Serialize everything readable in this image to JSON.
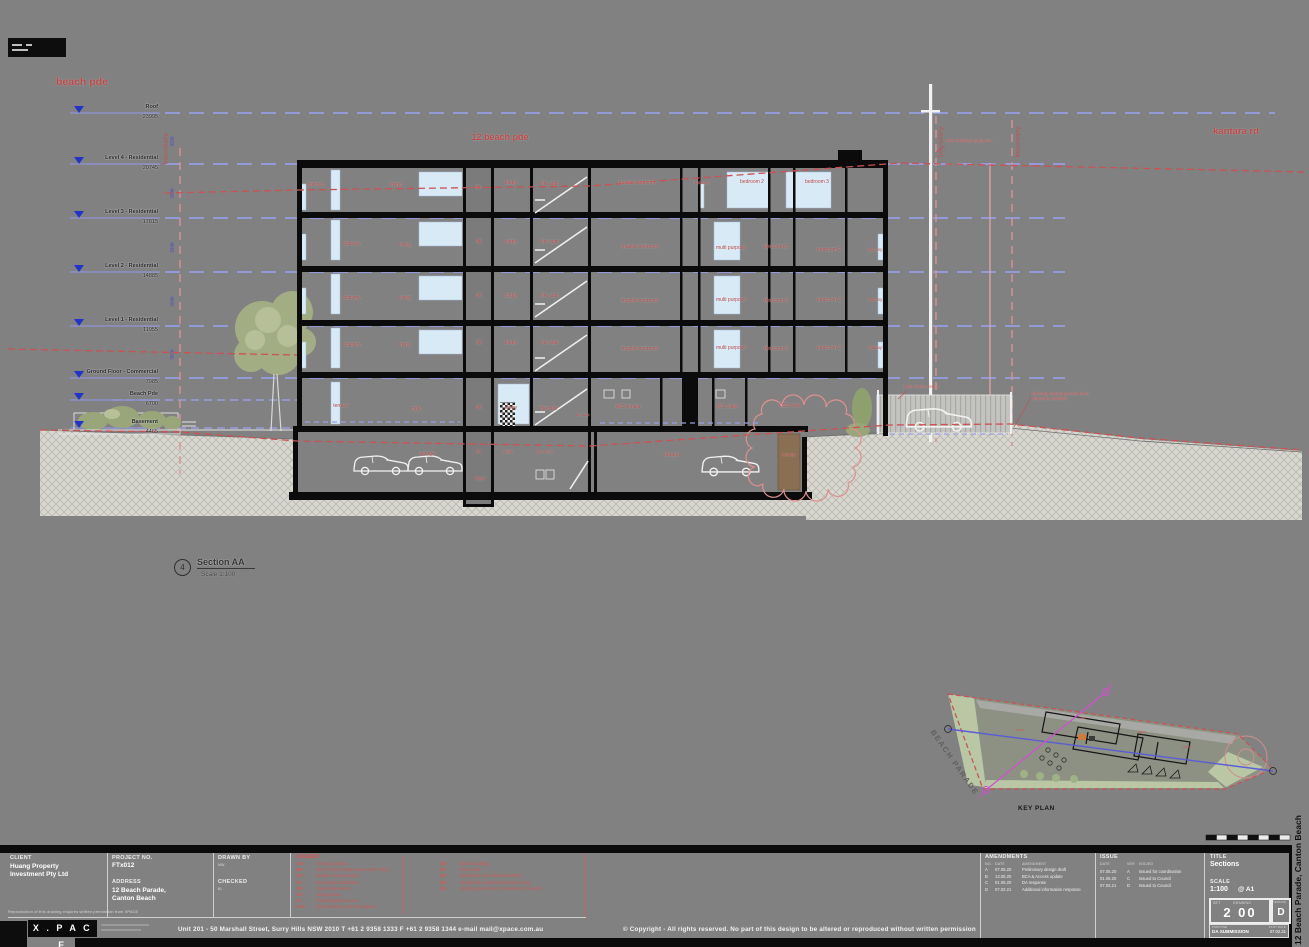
{
  "streets": {
    "beach_pde": "beach pde",
    "site": "12 beach pde",
    "kantara_rd": "kantara rd"
  },
  "drawing": {
    "boundary_label": "boundary",
    "boundary_positions": [
      {
        "x": 166,
        "y": 145
      },
      {
        "x": 941,
        "y": 138
      },
      {
        "x": 1018,
        "y": 138
      }
    ],
    "level_markers": [
      {
        "name": "Roof",
        "rl": "23995",
        "y": 113
      },
      {
        "name": "Level 4 - Residential",
        "rl": "20745",
        "y": 164
      },
      {
        "name": "Level 3 - Residential",
        "rl": "17815",
        "y": 218
      },
      {
        "name": "Level 2 - Residential",
        "rl": "14885",
        "y": 272
      },
      {
        "name": "Level 1 - Residential",
        "rl": "11955",
        "y": 326
      },
      {
        "name": "Ground Floor - Commercial",
        "rl": "7985",
        "y": 378
      },
      {
        "name": "Beach Pde",
        "rl": "6700",
        "y": 400
      },
      {
        "name": "Basement",
        "rl": "4465",
        "y": 428
      }
    ],
    "dims": [
      {
        "v": "3250",
        "y": 139
      },
      {
        "v": "2930",
        "y": 191
      },
      {
        "v": "2930",
        "y": 245
      },
      {
        "v": "2930",
        "y": 299
      },
      {
        "v": "3970",
        "y": 352
      }
    ],
    "room_labels": [
      {
        "t": "balcony",
        "x": 316,
        "y": 183,
        "w": 30
      },
      {
        "t": "living",
        "x": 396,
        "y": 183,
        "w": 30
      },
      {
        "t": "lift",
        "x": 478,
        "y": 186,
        "w": 20
      },
      {
        "t": "lobby",
        "x": 511,
        "y": 181,
        "w": 24
      },
      {
        "t": "fire stair",
        "x": 550,
        "y": 182,
        "w": 40
      },
      {
        "t": "master bedroom",
        "x": 637,
        "y": 181,
        "w": 40
      },
      {
        "t": "balcony",
        "x": 702,
        "y": 181,
        "w": 26,
        "s": 4.2
      },
      {
        "t": "bedroom 2",
        "x": 752,
        "y": 180,
        "w": 50
      },
      {
        "t": "bedroom 3",
        "x": 817,
        "y": 180,
        "w": 50
      },
      {
        "t": "balcony",
        "x": 352,
        "y": 242,
        "w": 30
      },
      {
        "t": "living",
        "x": 405,
        "y": 243,
        "w": 30
      },
      {
        "t": "lift",
        "x": 479,
        "y": 240,
        "w": 20
      },
      {
        "t": "lobby",
        "x": 511,
        "y": 240,
        "w": 24
      },
      {
        "t": "fire stair",
        "x": 550,
        "y": 240,
        "w": 40
      },
      {
        "t": "master bedroom",
        "x": 640,
        "y": 245,
        "w": 40
      },
      {
        "t": "multi purpose",
        "x": 731,
        "y": 246,
        "w": 60
      },
      {
        "t": "bedroom 3",
        "x": 776,
        "y": 245,
        "w": 26
      },
      {
        "t": "bedroom 2",
        "x": 829,
        "y": 248,
        "w": 42
      },
      {
        "t": "balcony",
        "x": 875,
        "y": 248,
        "w": 28,
        "s": 4.2
      },
      {
        "t": "balcony",
        "x": 352,
        "y": 296,
        "w": 30
      },
      {
        "t": "living",
        "x": 405,
        "y": 296,
        "w": 30
      },
      {
        "t": "lift",
        "x": 479,
        "y": 294,
        "w": 20
      },
      {
        "t": "lobby",
        "x": 511,
        "y": 294,
        "w": 24
      },
      {
        "t": "fire stair",
        "x": 550,
        "y": 294,
        "w": 40
      },
      {
        "t": "master bedroom",
        "x": 640,
        "y": 299,
        "w": 40
      },
      {
        "t": "multi purpose",
        "x": 731,
        "y": 298,
        "w": 60
      },
      {
        "t": "bedroom 3",
        "x": 776,
        "y": 299,
        "w": 26
      },
      {
        "t": "bedroom 2",
        "x": 829,
        "y": 298,
        "w": 42
      },
      {
        "t": "balcony",
        "x": 875,
        "y": 298,
        "w": 28,
        "s": 4.2
      },
      {
        "t": "balcony",
        "x": 352,
        "y": 343,
        "w": 30
      },
      {
        "t": "living",
        "x": 405,
        "y": 343,
        "w": 30
      },
      {
        "t": "lift",
        "x": 479,
        "y": 341,
        "w": 20
      },
      {
        "t": "lobby",
        "x": 511,
        "y": 341,
        "w": 24
      },
      {
        "t": "fire stair",
        "x": 550,
        "y": 341,
        "w": 40
      },
      {
        "t": "master bedroom",
        "x": 640,
        "y": 347,
        "w": 40
      },
      {
        "t": "multi purpose",
        "x": 731,
        "y": 346,
        "w": 60
      },
      {
        "t": "bedroom 3",
        "x": 776,
        "y": 347,
        "w": 26
      },
      {
        "t": "bedroom 2",
        "x": 829,
        "y": 346,
        "w": 42
      },
      {
        "t": "hallway",
        "x": 875,
        "y": 346,
        "w": 32,
        "s": 4.2
      },
      {
        "t": "terrace",
        "x": 341,
        "y": 404,
        "w": 32
      },
      {
        "t": "cafe",
        "x": 416,
        "y": 407,
        "w": 26
      },
      {
        "t": "lift",
        "x": 479,
        "y": 406,
        "w": 20
      },
      {
        "t": "lobby",
        "x": 511,
        "y": 406,
        "w": 24
      },
      {
        "t": "fire stair",
        "x": 549,
        "y": 407,
        "w": 40
      },
      {
        "t": "fire stair",
        "x": 583,
        "y": 413,
        "w": 20,
        "s": 3.8
      },
      {
        "t": "WC female",
        "x": 628,
        "y": 405,
        "w": 26
      },
      {
        "t": "WC male",
        "x": 727,
        "y": 405,
        "w": 24
      },
      {
        "t": "OSD tank",
        "x": 790,
        "y": 404,
        "w": 36
      },
      {
        "t": "garage",
        "x": 427,
        "y": 452,
        "w": 30
      },
      {
        "t": "lift",
        "x": 479,
        "y": 450,
        "w": 18,
        "s": 4.2
      },
      {
        "t": "lift pit",
        "x": 480,
        "y": 477,
        "w": 26,
        "s": 4.2
      },
      {
        "t": "lobby",
        "x": 508,
        "y": 450,
        "w": 24,
        "s": 4.2
      },
      {
        "t": "bin room",
        "x": 545,
        "y": 450,
        "w": 22,
        "s": 4.2
      },
      {
        "t": "garage",
        "x": 672,
        "y": 453,
        "w": 30
      },
      {
        "t": "storage",
        "x": 789,
        "y": 453,
        "w": 34,
        "s": 4.2
      }
    ],
    "annotations": {
      "height_line": "13m building height line",
      "timber_fence": "1.8m timber fence",
      "ground_note_1": "Existing natural ground level",
      "ground_note_2": "shown as dashed"
    },
    "section_callout": {
      "bubble": "4",
      "name": "Section AA",
      "scale": "Scale  1:100"
    },
    "key_plan": {
      "caption": "KEY PLAN",
      "street": "BEACH PARADE"
    }
  },
  "titleblock": {
    "client_label": "CLIENT",
    "client_1": "Huang Property",
    "client_2": "Investment Pty Ltd",
    "project_no_label": "PROJECT NO.",
    "project_no": "FTx012",
    "address_label": "ADDRESS",
    "address_1": "12 Beach Parade,",
    "address_2": "Canton Beach",
    "drawn_label": "DRAWN BY",
    "drawn": "MW",
    "checked_label": "CHECKED",
    "checked": "BL",
    "legend_label": "LEGEND",
    "legend_col1": [
      {
        "code": "AW",
        "desc": "Awning window"
      },
      {
        "code": "BB",
        "desc": "Breeze block (style and colour TBC)"
      },
      {
        "code": "DH",
        "desc": "Double hung window"
      },
      {
        "code": "FG",
        "desc": "Fixed glass windows"
      },
      {
        "code": "GB",
        "desc": "Glass balustrade"
      },
      {
        "code": "HD",
        "desc": "Hinged door"
      },
      {
        "code": "LV",
        "desc": "Fixed blades louvres"
      },
      {
        "code": "LVG",
        "desc": "Fixed blades over fixed glass"
      }
    ],
    "legend_col2": [
      {
        "code": "MC",
        "desc": "Metal cladding"
      },
      {
        "code": "PD",
        "desc": "Pivot door"
      },
      {
        "code": "RE",
        "desc": "Rendered and Painted (White)"
      },
      {
        "code": "RD",
        "desc": "Rendered and Painted (Dark Grey)"
      },
      {
        "code": "SD",
        "desc": "Sliding glass doors (Aluminium Framed)"
      }
    ],
    "amendments_label": "AMENDMENTS",
    "amendments_cols": [
      "NO.",
      "DATE",
      "AMENDMENT"
    ],
    "amendments": [
      {
        "no": "A",
        "date": "07.05.20",
        "desc": "Preliminary design draft"
      },
      {
        "no": "B",
        "date": "13.05.20",
        "desc": "BCA & Access update"
      },
      {
        "no": "C",
        "date": "01.06.20",
        "desc": "DA response"
      },
      {
        "no": "D",
        "date": "07.02.21",
        "desc": "Additional information response"
      }
    ],
    "issue_label": "ISSUE",
    "issue_cols": [
      "DATE",
      "VER",
      "ISSUED"
    ],
    "issues": [
      {
        "date": "07.05.20",
        "ver": "A",
        "desc": "Issued for coordination"
      },
      {
        "date": "01.06.20",
        "ver": "C",
        "desc": "Issued to Council"
      },
      {
        "date": "07.02.21",
        "ver": "D",
        "desc": "Issued to Council"
      }
    ],
    "title_label": "TITLE",
    "title": "Sections",
    "scale_label": "SCALE",
    "scale": "1:100",
    "scale_paper": "@ A1",
    "no_label_left": "SET",
    "no_label_right": "DRAWING",
    "drawing_no": "2 00",
    "version_label": "VERSION",
    "version": "D",
    "purpose_label": "PURPOSE",
    "purpose": "DA SUBMISSION",
    "plot_label": "PLOT DATE",
    "plot_date": "07.02.21"
  },
  "footer": {
    "note": "Reproduction of this drawing requires written permission from XPACE",
    "logo": "X . P A C E",
    "address": "Unit 201 - 50 Marshall Street, Surry Hills NSW 2010      T  +61 2 9358 1333    F  +61 2 9358 1344      e-mail   mail@xpace.com.au",
    "copyright": "© Copyright - All rights reserved. No part of this design to be altered or reproduced without written permission"
  },
  "side_text": "12 Beach Parade, Canton Beach",
  "colors": {
    "sheet": "#818181",
    "glass": "#d9eaf7",
    "annotation_red": "#c25050",
    "level_line_blue": "#979de0",
    "datum_blue": "#2233cc"
  }
}
